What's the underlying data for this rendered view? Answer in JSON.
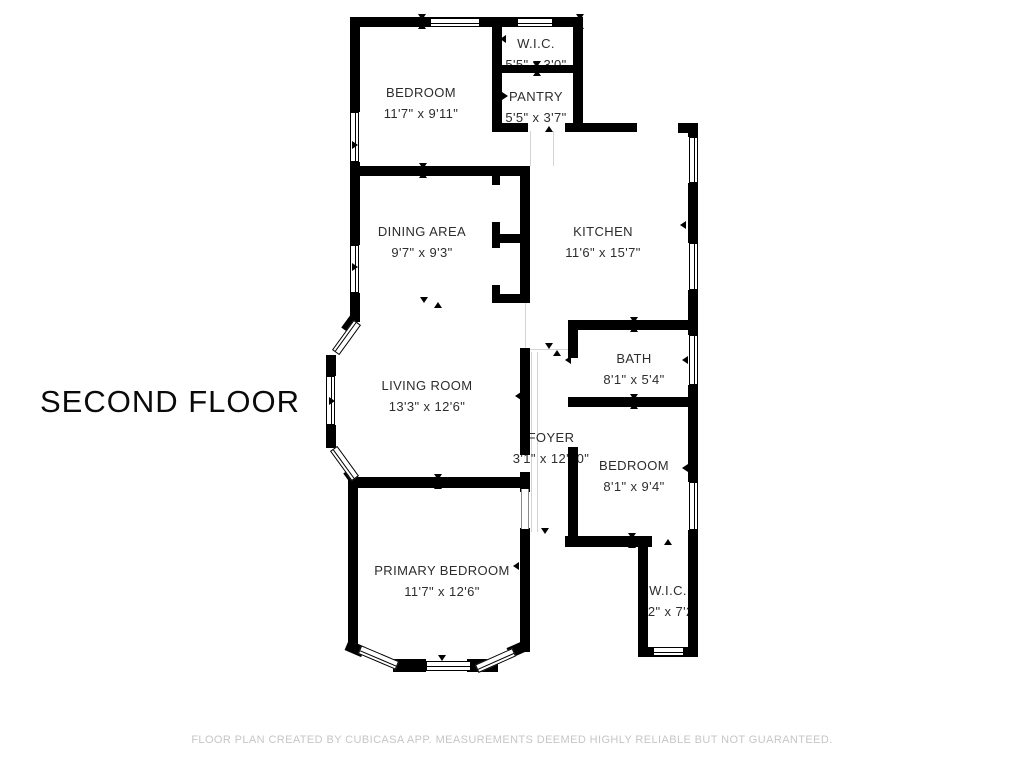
{
  "floor_title": "SECOND FLOOR",
  "footer_text": "FLOOR PLAN CREATED BY CUBICASA APP. MEASUREMENTS DEEMED HIGHLY RELIABLE BUT NOT GUARANTEED.",
  "rooms": {
    "bedroom1": {
      "name": "BEDROOM",
      "dims": "11'7\" x 9'11\""
    },
    "wic1": {
      "name": "W.I.C.",
      "dims": "5'5\" x 3'0\""
    },
    "pantry": {
      "name": "PANTRY",
      "dims": "5'5\" x 3'7\""
    },
    "dining": {
      "name": "DINING AREA",
      "dims": "9'7\" x 9'3\""
    },
    "kitchen": {
      "name": "KITCHEN",
      "dims": "11'6\" x 15'7\""
    },
    "living": {
      "name": "LIVING ROOM",
      "dims": "13'3\" x 12'6\""
    },
    "foyer": {
      "name": "FOYER",
      "dims": "3'1\" x 12'10\""
    },
    "bath": {
      "name": "BATH",
      "dims": "8'1\" x 5'4\""
    },
    "bedroom2": {
      "name": "BEDROOM",
      "dims": "8'1\" x 9'4\""
    },
    "primary": {
      "name": "PRIMARY BEDROOM",
      "dims": "11'7\" x 12'6\""
    },
    "wic2": {
      "name": "W.I.C.",
      "dims": "3'2\" x 7'2\""
    }
  },
  "colors": {
    "wall": "#000000",
    "label_text": "#2d2d2d",
    "floor_title_text": "#0a0a0a",
    "footer_text": "#c6c6c6",
    "opening_line": "#d4d4d4",
    "background": "#ffffff"
  }
}
